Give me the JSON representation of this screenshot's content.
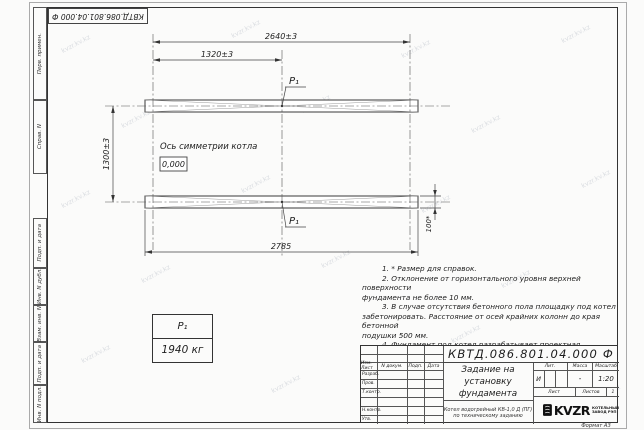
{
  "watermark_text": "kvzr.kv.kz",
  "corner_stamp": "КВТД.086.801.04.000 Ф",
  "side_strip": [
    "Перв. примен.",
    "Справ. N",
    "Подп. и дата",
    "Инв. N дубл.",
    "Взам. инв. N",
    "Подп. и дата",
    "Инв. N подл."
  ],
  "drawing": {
    "dim_top_full": "2640±3",
    "dim_top_half": "1320±3",
    "dim_left_vertical": "1300±3",
    "dim_bottom": "2785",
    "dim_pad_height": "100*",
    "symmetry_axis_label": "Ось симметрии котла",
    "level_mark": "0,000",
    "load_point_top": "P₁",
    "load_point_bottom": "P₁"
  },
  "load_table": {
    "header": "P₁",
    "value": "1940 кг"
  },
  "notes": [
    "1. * Размер для справок.",
    "2. Отклонение от горизонтального уровня верхней поверхности",
    "фундамента не более 10 мм.",
    "3. В случае отсутствия бетонного пола площадку под котел",
    "забетонировать. Расстояние от осей крайних колонн до края бетонной",
    "подушки 500 мм.",
    "4. Фундамент под котел разрабатывает проектная организация",
    "по нагрузкам на фундамент."
  ],
  "title_block": {
    "doc_number": "КВТД.086.801.04.000 Ф",
    "title_line1": "Задание на",
    "title_line2": "установку",
    "title_line3": "фундамента",
    "product_line1": "Котел водогрейный КВ-1,0 Д (ПГ)",
    "product_line2": "по техническому заданию",
    "col_headers": [
      "Изм. Лист",
      "N докум.",
      "Подп.",
      "Дата"
    ],
    "row_labels": [
      "Разраб.",
      "Пров.",
      "Т.контр.",
      "",
      "Н.контр.",
      "Утв."
    ],
    "lit_header": "Лит.",
    "mass_header": "Масса",
    "scale_header": "Масштаб",
    "lit_value": "И",
    "mass_value": "-",
    "scale_value": "1:20",
    "sheet_label": "Лист",
    "sheets_label": "Листов",
    "sheets_value": "1",
    "logo_name": "KVZR",
    "logo_caption_line1": "КОТЕЛЬНЫЙ",
    "logo_caption_line2": "ЗАВОД РЭП",
    "format_note": "Формат А3"
  }
}
